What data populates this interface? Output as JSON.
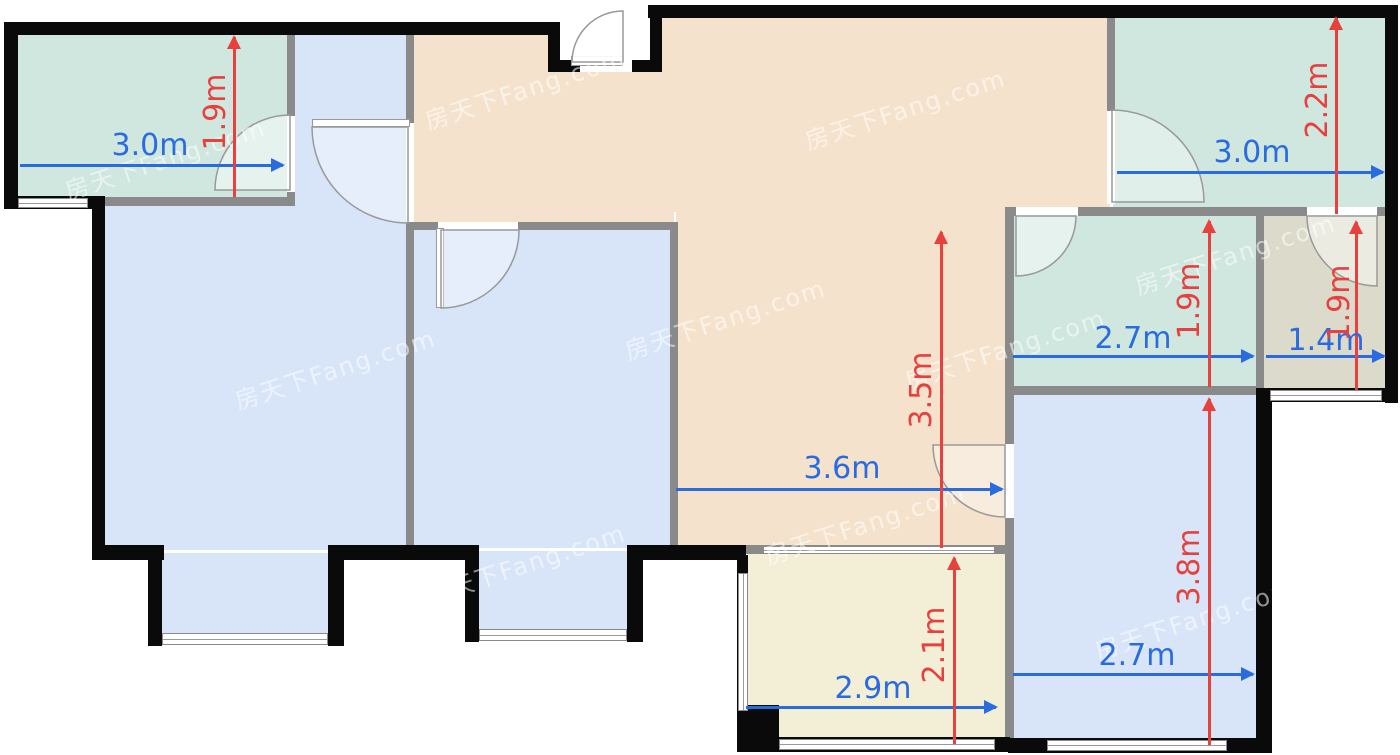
{
  "watermark": {
    "text": "房天下Fang.com"
  },
  "dimensions": {
    "balcony_top_left": {
      "width": "3.0m",
      "height": "1.9m"
    },
    "bedroom_top_right": {
      "width": "3.0m",
      "height": "2.2m"
    },
    "bathroom_right": {
      "width": "2.7m",
      "height": "1.9m"
    },
    "storage_right": {
      "width": "1.4m",
      "height": "1.9m"
    },
    "living_room": {
      "width": "3.6m",
      "height": "3.5m"
    },
    "bedroom_bottom_right": {
      "width": "2.7m",
      "height": "3.8m"
    },
    "balcony_bottom": {
      "width": "2.9m",
      "height": "2.1m"
    }
  },
  "colors": {
    "dimension_blue": "#2b6be0",
    "dimension_red": "#e8403d",
    "room_teal": "#cfe7df",
    "room_blue": "#d8e5f8",
    "room_orange": "#f5e2cd",
    "room_yellow": "#f2efd6",
    "room_tan": "#dcdacb",
    "wall_black": "#0a0a0a",
    "wall_gray": "#8a8a8a"
  }
}
